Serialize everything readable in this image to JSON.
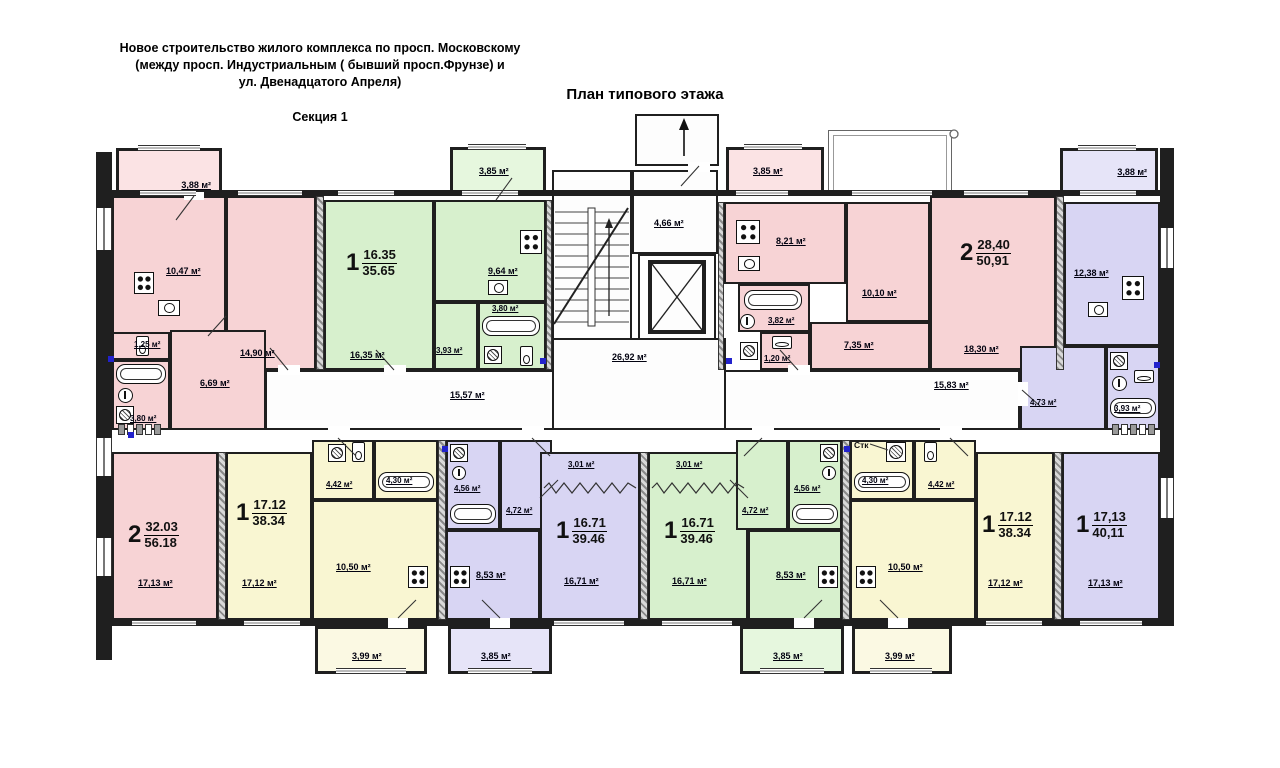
{
  "header": {
    "title_line1": "Новое строительство жилого комплекса по просп. Московскому",
    "title_line2": "(между просп. Индустриальным ( бывший просп.Фрунзе) и",
    "title_line3": "ул. Двенадцатого Апреля)",
    "section_label": "Секция 1",
    "plan_title": "План типового этажа"
  },
  "core": {
    "lobby_area": "4,66 м²",
    "stair_hall_area": "26,92 м²",
    "corridor_left_area": "15,57 м²",
    "corridor_right_area": "15,83 м²",
    "washer_note": "Стк"
  },
  "colors": {
    "pink": "#f7d3d5",
    "green": "#d7f0cd",
    "purple": "#d8d5f3",
    "yellow": "#f9f6d2",
    "wall": "#1f1f1f"
  },
  "apartments": [
    {
      "id": "left-two-room",
      "color": "pink",
      "rooms_count": "2",
      "area_living": "32.03",
      "area_total": "56.18",
      "rooms": {
        "balcony": "3,88 м²",
        "kitchen": "10,47 м²",
        "bedroom": "14,90 м²",
        "wc": "1,25 м²",
        "bath": "3,80 м²",
        "hall": "6,69 м²",
        "living": "17,13 м²"
      }
    },
    {
      "id": "green-top",
      "color": "green",
      "rooms_count": "1",
      "area_living": "16.35",
      "area_total": "35.65",
      "rooms": {
        "living": "16,35 м²",
        "kitchen": "9,64 м²",
        "bath": "3,80 м²",
        "hall": "3,93 м²",
        "balcony": "3,85 м²"
      }
    },
    {
      "id": "pink-right",
      "color": "pink",
      "rooms_count": "2",
      "area_living": "28,40",
      "area_total": "50,91",
      "rooms": {
        "balcony": "3,85 м²",
        "kitchen": "8,21 м²",
        "bedroom": "10,10 м²",
        "living": "18,30 м²",
        "bath": "3,82 м²",
        "wc": "1,20 м²",
        "hall": "7,35 м²"
      }
    },
    {
      "id": "purple-right",
      "color": "purple",
      "rooms_count": "1",
      "area_living": "17,13",
      "area_total": "40,11",
      "rooms": {
        "balcony": "3,88 м²",
        "kitchen": "12,38 м²",
        "hall": "4,73 м²",
        "bath": "3,93 м²",
        "living": "17,13 м²"
      }
    },
    {
      "id": "yellow-left",
      "color": "yellow",
      "rooms_count": "1",
      "area_living": "17.12",
      "area_total": "38.34",
      "rooms": {
        "living": "17,12 м²",
        "hall": "4,42 м²",
        "bath": "4,30 м²",
        "kitchen": "10,50 м²",
        "balcony": "3,99 м²"
      }
    },
    {
      "id": "purple-mid",
      "color": "purple",
      "rooms_count": "1",
      "area_living": "16.71",
      "area_total": "39.46",
      "rooms": {
        "bath": "4,56 м²",
        "hall": "4,72 м²",
        "kitchen": "8,53 м²",
        "living": "16,71 м²",
        "loggia": "3,01 м²",
        "balcony": "3,85 м²"
      }
    },
    {
      "id": "green-mid",
      "color": "green",
      "rooms_count": "1",
      "area_living": "16.71",
      "area_total": "39.46",
      "rooms": {
        "bath": "4,56 м²",
        "hall": "4,72 м²",
        "kitchen": "8,53 м²",
        "living": "16,71 м²",
        "loggia": "3,01 м²",
        "balcony": "3,85 м²"
      }
    },
    {
      "id": "yellow-right",
      "color": "yellow",
      "rooms_count": "1",
      "area_living": "17.12",
      "area_total": "38.34",
      "rooms": {
        "living": "17,12 м²",
        "hall": "4,42 м²",
        "bath": "4,30 м²",
        "kitchen": "10,50 м²",
        "balcony": "3,99 м²"
      }
    }
  ]
}
